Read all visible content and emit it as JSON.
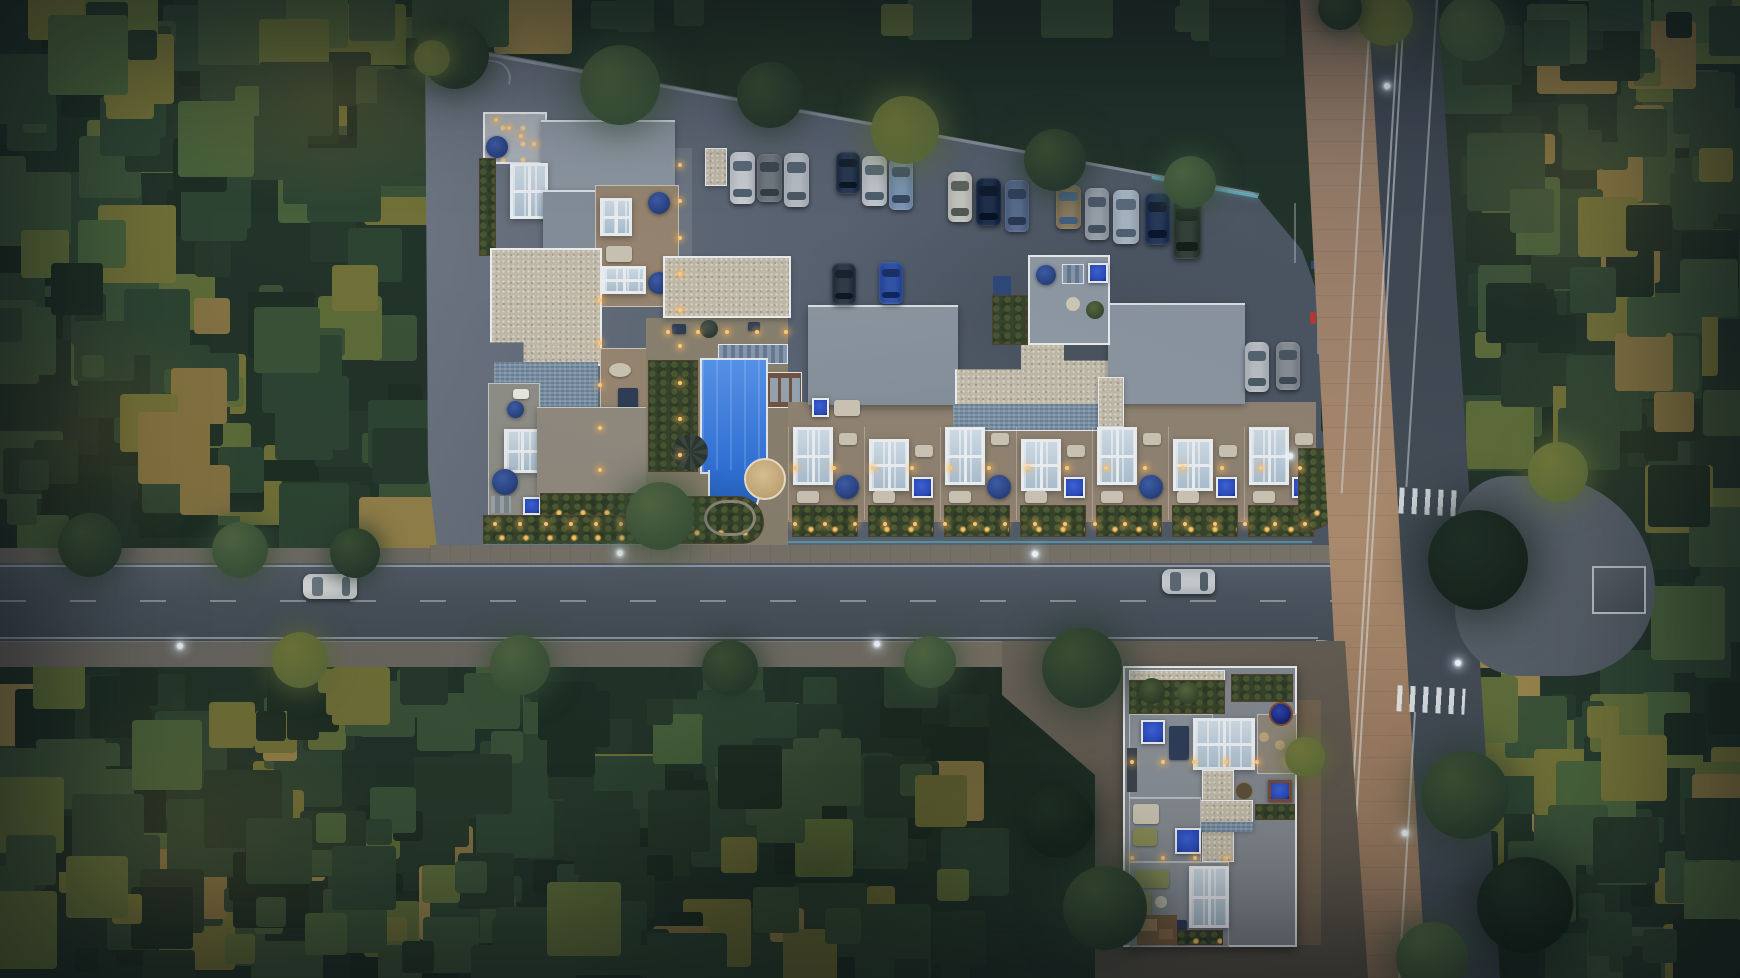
{
  "scene": {
    "kind": "aerial-render",
    "description": "Dusk top-down aerial rendering of a residential complex with rooftop terraces, pool, parking lot and T-road intersection surrounded by forest",
    "width": 1740,
    "height": 978
  },
  "palette": {
    "site_asphalt": "#57606c",
    "road_asphalt": "#49525c",
    "vroad_asphalt": "#3f4751",
    "sidewalk_tan": "#9a7d64",
    "sidewalk_gray": "#6e6b63",
    "roof_gray": "#8b95a0",
    "roof_light": "#a9b0b7",
    "gravel": "#bfb8a8",
    "glass": "#b9c7d3",
    "frame_white": "#e9ecef",
    "pool_blue": "#2f6fd4",
    "spa_blue": "#2847b4",
    "umbrella_blue": "#27407c",
    "hedge_green": "#36422a",
    "terrace_tan": "#95846f",
    "shingle_blue": "#7e94a8",
    "warm_light": "#ffc878",
    "accent_cyan": "#6fd8ea"
  },
  "vehicles": {
    "parked_row": [
      {
        "x": 730,
        "y": 152,
        "w": 25,
        "h": 52,
        "c": "#c7ccd1",
        "g": "#5a6a7a"
      },
      {
        "x": 757,
        "y": 154,
        "w": 25,
        "h": 48,
        "c": "#70787f",
        "g": "#3e4750"
      },
      {
        "x": 784,
        "y": 153,
        "w": 25,
        "h": 54,
        "c": "#b6bdc4",
        "g": "#55626f"
      },
      {
        "x": 836,
        "y": 152,
        "w": 24,
        "h": 42,
        "c": "#2a3950",
        "g": "#16202f"
      },
      {
        "x": 862,
        "y": 156,
        "w": 25,
        "h": 50,
        "c": "#c2c8ce",
        "g": "#5a6a7a"
      },
      {
        "x": 889,
        "y": 158,
        "w": 24,
        "h": 52,
        "c": "#7e97b5",
        "g": "#42536b"
      },
      {
        "x": 948,
        "y": 172,
        "w": 24,
        "h": 50,
        "c": "#c6c6c0",
        "g": "#5c655f"
      },
      {
        "x": 976,
        "y": 178,
        "w": 25,
        "h": 48,
        "c": "#20304b",
        "g": "#101b2c"
      },
      {
        "x": 1005,
        "y": 180,
        "w": 24,
        "h": 52,
        "c": "#5a6d8e",
        "g": "#32425c"
      },
      {
        "x": 1056,
        "y": 185,
        "w": 25,
        "h": 44,
        "c": "#8d7d61",
        "g": "#4d6a8a"
      },
      {
        "x": 1085,
        "y": 188,
        "w": 24,
        "h": 52,
        "c": "#9aa2ab",
        "g": "#4e5b69"
      },
      {
        "x": 1113,
        "y": 190,
        "w": 26,
        "h": 54,
        "c": "#a9b6c2",
        "g": "#5b6b7c"
      },
      {
        "x": 1145,
        "y": 193,
        "w": 25,
        "h": 52,
        "c": "#27395a",
        "g": "#141f33"
      },
      {
        "x": 1173,
        "y": 199,
        "w": 28,
        "h": 60,
        "c": "#34413a",
        "g": "#1d2822"
      }
    ],
    "lot_cars": [
      {
        "x": 832,
        "y": 263,
        "w": 24,
        "h": 42,
        "c": "#2e3a46",
        "g": "#18222c"
      },
      {
        "x": 879,
        "y": 262,
        "w": 24,
        "h": 42,
        "c": "#3254a6",
        "g": "#1b3166"
      }
    ],
    "corner_cars": [
      {
        "x": 1245,
        "y": 342,
        "w": 24,
        "h": 50,
        "c": "#b9bec3",
        "g": "#566470"
      },
      {
        "x": 1276,
        "y": 342,
        "w": 24,
        "h": 48,
        "c": "#878e95",
        "g": "#49545e"
      }
    ],
    "driving_cars": [
      {
        "x": 303,
        "y": 574,
        "w": 54,
        "h": 25,
        "c": "#d6d8d9",
        "g": "#6a7884"
      },
      {
        "x": 1162,
        "y": 569,
        "w": 53,
        "h": 25,
        "c": "#c3c8cc",
        "g": "#5b6873"
      }
    ]
  },
  "street_lights": [
    {
      "x": 343,
      "y": 557
    },
    {
      "x": 620,
      "y": 553
    },
    {
      "x": 1035,
      "y": 554
    },
    {
      "x": 180,
      "y": 646
    },
    {
      "x": 877,
      "y": 644
    },
    {
      "x": 1290,
      "y": 456
    },
    {
      "x": 1387,
      "y": 86
    },
    {
      "x": 1405,
      "y": 833
    },
    {
      "x": 1458,
      "y": 663
    }
  ],
  "path_light_runs": [
    {
      "x1": 680,
      "y1": 165,
      "x2": 680,
      "y2": 455,
      "n": 9
    },
    {
      "x1": 495,
      "y1": 524,
      "x2": 672,
      "y2": 524,
      "n": 8
    },
    {
      "x1": 795,
      "y1": 524,
      "x2": 1305,
      "y2": 524,
      "n": 18
    },
    {
      "x1": 795,
      "y1": 468,
      "x2": 1300,
      "y2": 468,
      "n": 14
    },
    {
      "x1": 668,
      "y1": 332,
      "x2": 786,
      "y2": 332,
      "n": 5
    },
    {
      "x1": 600,
      "y1": 300,
      "x2": 600,
      "y2": 470,
      "n": 5
    },
    {
      "x1": 1132,
      "y1": 762,
      "x2": 1288,
      "y2": 762,
      "n": 6
    },
    {
      "x1": 1132,
      "y1": 858,
      "x2": 1226,
      "y2": 858,
      "n": 4
    },
    {
      "x1": 496,
      "y1": 120,
      "x2": 534,
      "y2": 144,
      "n": 4
    }
  ],
  "building_b_units": [
    {
      "glass": "high",
      "feature": "circle"
    },
    {
      "glass": "low",
      "feature": "square"
    },
    {
      "glass": "high",
      "feature": "circle"
    },
    {
      "glass": "low",
      "feature": "square"
    },
    {
      "glass": "high",
      "feature": "circle"
    },
    {
      "glass": "low",
      "feature": "square"
    },
    {
      "glass": "high",
      "feature": "square"
    }
  ],
  "landscape": {
    "tree_seed": 987654321,
    "tree_count": 640,
    "tree_palette": [
      "#1e2e25",
      "#27392c",
      "#2e4433",
      "#3a5138",
      "#47603b",
      "#5d6b39",
      "#707038",
      "#837242",
      "#93804a"
    ],
    "overhang_trees": [
      {
        "x": 455,
        "y": 55,
        "r": 34,
        "c": 1
      },
      {
        "x": 620,
        "y": 85,
        "r": 40,
        "c": 2
      },
      {
        "x": 770,
        "y": 95,
        "r": 33,
        "c": 1
      },
      {
        "x": 905,
        "y": 130,
        "r": 34,
        "c": 3
      },
      {
        "x": 1055,
        "y": 160,
        "r": 31,
        "c": 1
      },
      {
        "x": 1190,
        "y": 182,
        "r": 26,
        "c": 2
      },
      {
        "x": 432,
        "y": 58,
        "r": 18,
        "c": 3
      },
      {
        "x": 660,
        "y": 516,
        "r": 34,
        "c": 2
      },
      {
        "x": 90,
        "y": 545,
        "r": 32,
        "c": 1
      },
      {
        "x": 240,
        "y": 550,
        "r": 28,
        "c": 2
      },
      {
        "x": 355,
        "y": 553,
        "r": 25,
        "c": 1
      },
      {
        "x": 300,
        "y": 660,
        "r": 28,
        "c": 3
      },
      {
        "x": 520,
        "y": 665,
        "r": 30,
        "c": 2
      },
      {
        "x": 730,
        "y": 668,
        "r": 28,
        "c": 1
      },
      {
        "x": 930,
        "y": 662,
        "r": 26,
        "c": 2
      },
      {
        "x": 1478,
        "y": 560,
        "r": 50,
        "c": 0
      },
      {
        "x": 1558,
        "y": 472,
        "r": 30,
        "c": 3
      },
      {
        "x": 1082,
        "y": 668,
        "r": 40,
        "c": 1
      },
      {
        "x": 1058,
        "y": 822,
        "r": 36,
        "c": 0
      },
      {
        "x": 1105,
        "y": 908,
        "r": 42,
        "c": 1
      },
      {
        "x": 1305,
        "y": 757,
        "r": 20,
        "c": 3
      },
      {
        "x": 1465,
        "y": 795,
        "r": 44,
        "c": 1
      },
      {
        "x": 1525,
        "y": 905,
        "r": 48,
        "c": 0
      },
      {
        "x": 1432,
        "y": 958,
        "r": 36,
        "c": 2
      },
      {
        "x": 1385,
        "y": 18,
        "r": 28,
        "c": 3
      },
      {
        "x": 1472,
        "y": 28,
        "r": 33,
        "c": 2
      },
      {
        "x": 1340,
        "y": 8,
        "r": 22,
        "c": 1
      }
    ]
  }
}
